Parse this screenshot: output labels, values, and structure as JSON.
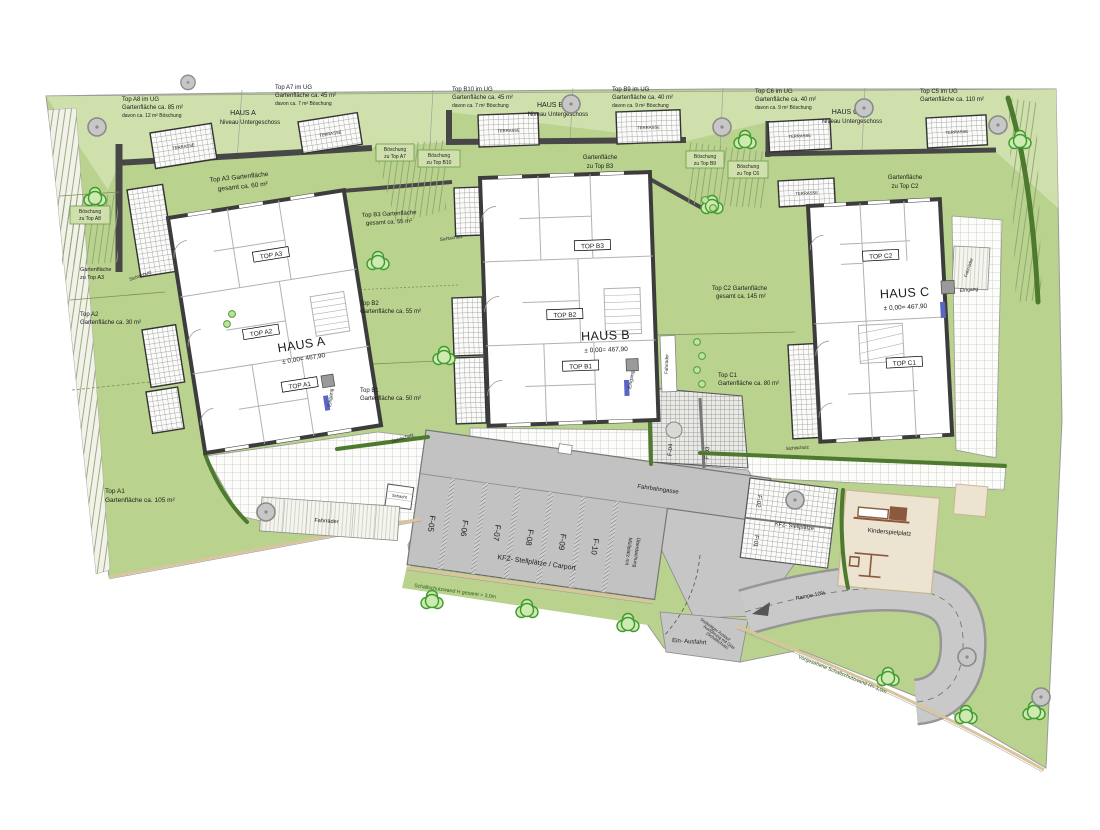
{
  "colors": {
    "garden_green": "#b9d28e",
    "upper_green": "#cfe0ad",
    "hedge_green": "#4e7a2e",
    "wall_gray": "#474747",
    "parking_gray": "#c2c2c2",
    "playground_beige": "#ece3d0",
    "mailbox_blue": "#5a66c2",
    "tree_green": "#3f9b2f"
  },
  "upper": {
    "a8": {
      "l1": "Top A8 im UG",
      "l2": "Gartenfläche ca. 85 m²",
      "l3": "davon ca. 12 m² Böschung"
    },
    "hausA": {
      "l1": "HAUS A",
      "l2": "Niveau Untergeschoss"
    },
    "a7": {
      "l1": "Top A7 im UG",
      "l2": "Gartenfläche ca. 45 m²",
      "l3": "davon ca. 7 m² Böschung"
    },
    "b10": {
      "l1": "Top B10 im UG",
      "l2": "Gartenfläche ca. 45 m²",
      "l3": "davon ca. 7 m² Böschung"
    },
    "hausB": {
      "l1": "HAUS B",
      "l2": "Niveau Untergeschoss"
    },
    "b9": {
      "l1": "Top B9 im UG",
      "l2": "Gartenfläche ca. 40 m²",
      "l3": "davon ca. 9 m² Böschung"
    },
    "c6": {
      "l1": "Top C6 im UG",
      "l2": "Gartenfläche ca. 40 m²",
      "l3": "davon ca. 9 m² Böschung"
    },
    "hausC": {
      "l1": "HAUS C",
      "l2": "Niveau Untergeschoss"
    },
    "c5": {
      "l1": "Top C5 im UG",
      "l2": "Gartenfläche ca. 110 m²"
    }
  },
  "gardens": {
    "a3": {
      "l1": "Top A3 Gartenfläche",
      "l2": "gesamt ca. 60 m²"
    },
    "a2": {
      "l1": "Top A2",
      "l2": "Gartenfläche ca. 30 m²"
    },
    "a1": {
      "l1": "Top A1",
      "l2": "Gartenfläche ca. 105 m²"
    },
    "b3": {
      "l1": "Top B3 Gartenfläche",
      "l2": "gesamt ca. 55 m²"
    },
    "b2": {
      "l1": "Top B2",
      "l2": "Gartenfläche ca. 55 m²"
    },
    "b1": {
      "l1": "Top B1",
      "l2": "Gartenfläche ca. 50 m²"
    },
    "c2": {
      "l1": "Top C2 Gartenfläche",
      "l2": "gesamt ca. 145 m²"
    },
    "c1": {
      "l1": "Top C1",
      "l2": "Gartenfläche ca. 80 m²"
    },
    "gfa3": {
      "l1": "Gartenfläche",
      "l2": "zu Top A3"
    },
    "gfb3": {
      "l1": "Gartenfläche",
      "l2": "zu Top B3"
    },
    "gfc2": {
      "l1": "Gartenfläche",
      "l2": "zu Top C2"
    }
  },
  "slopes": {
    "a8": {
      "l1": "Böschung",
      "l2": "zu Top A8"
    },
    "a7": {
      "l1": "Böschung",
      "l2": "zu Top A7"
    },
    "b10": {
      "l1": "Böschung",
      "l2": "zu Top B10"
    },
    "b9": {
      "l1": "Böschung",
      "l2": "zu Top B9"
    },
    "c6": {
      "l1": "Böschung",
      "l2": "zu Top C6"
    }
  },
  "houses": {
    "a": {
      "name": "HAUS A",
      "level": "± 0,00= 467,90",
      "top1": "TOP A1",
      "top2": "TOP A2",
      "top3": "TOP A3"
    },
    "b": {
      "name": "HAUS B",
      "level": "± 0,00= 467,90",
      "top1": "TOP B1",
      "top2": "TOP B2",
      "top3": "TOP B3"
    },
    "c": {
      "name": "HAUS C",
      "level": "± 0,00= 467,90",
      "top1": "TOP C1",
      "top2": "TOP C2"
    }
  },
  "parking": {
    "lane": "Fahrbahngasse",
    "carport": "KFZ- Stellplätze / Carport",
    "stalls": [
      "F-05",
      "F-06",
      "F-07",
      "F-08",
      "F-09",
      "F-10"
    ],
    "muell1": "Müllplatz mit",
    "muell2": "Überdachung",
    "visitor": "KFZ- Stellplätze",
    "v1": "F-01",
    "v2": "F-02",
    "c3": "F-03",
    "c4": "F-04",
    "schacht": "Schacht"
  },
  "site": {
    "wall1": "Schallschutzwand H gesamt = 3,0m",
    "wall2": "Vorgesehene Schallschutzwand H= 3,0m",
    "glass1": "Südseitiger Auslauf",
    "glass2": "Ausführung mit Glas",
    "glass3": "(Schallschutz)",
    "entry": "Ein- Ausfahrt",
    "ramp": "Rampe 10%",
    "playground": "Kinderspielplatz",
    "terrace": "TERRASSE",
    "sicht": "Sichtschutz",
    "eingang": "Eingang",
    "bikes": "Fahrräder"
  }
}
